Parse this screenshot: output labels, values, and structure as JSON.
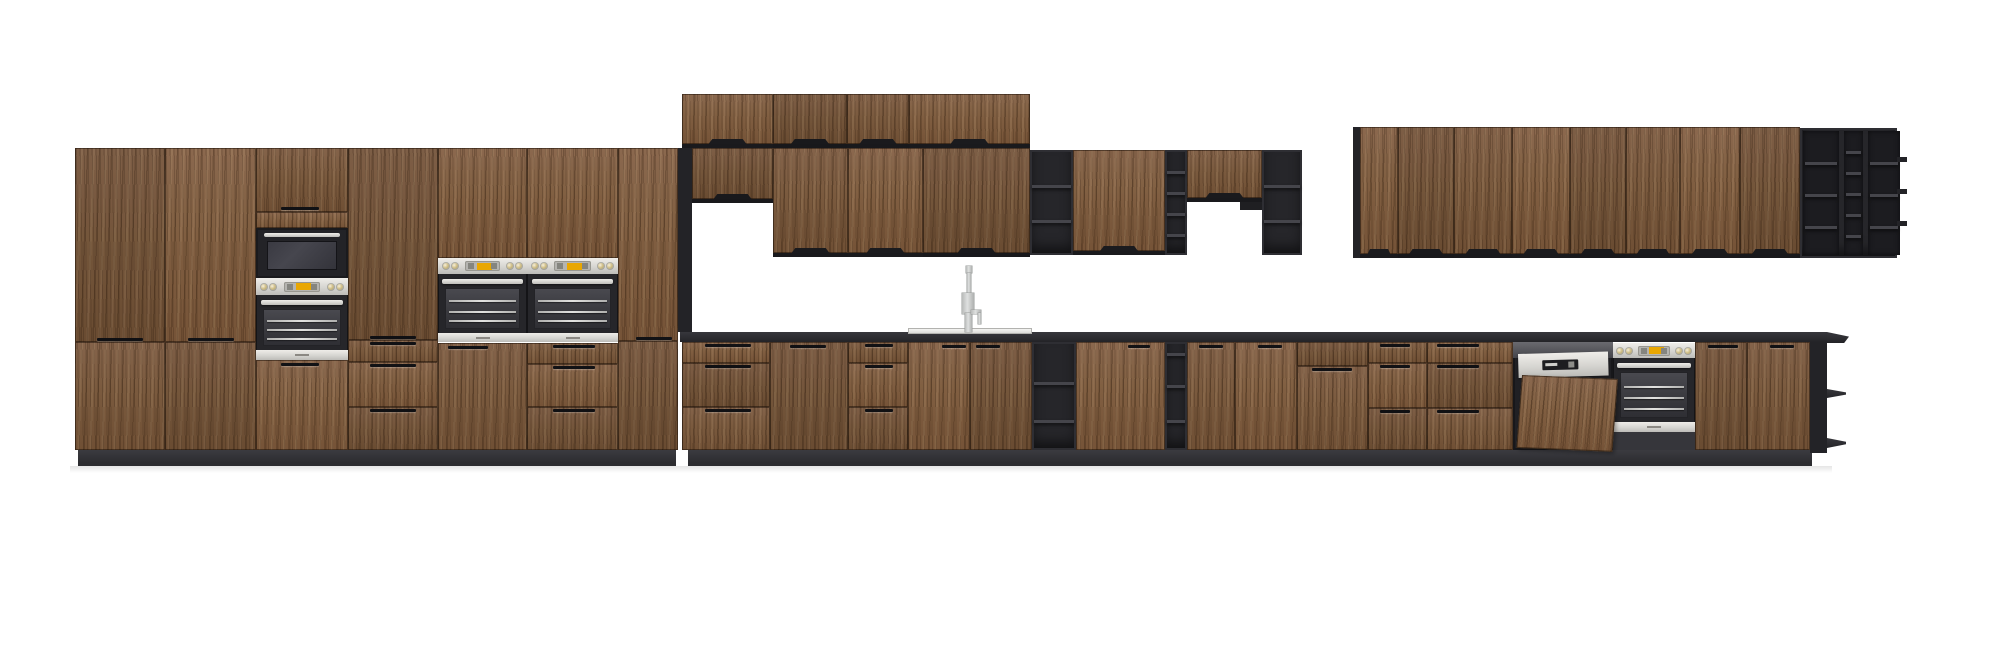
{
  "app": {
    "view_label": "kitchen-elevation-render"
  },
  "palette": {
    "wood": "#7a593c",
    "unit_black": "#232327",
    "counter": "#2b2b2f",
    "plinth": "#323236",
    "steel": "#d8d7d3",
    "display_amber": "#e9a702",
    "cavity": "#3c3c40",
    "sink": "#e9e9e7",
    "faucet": "#c5c7c7",
    "background": "#ffffff"
  },
  "scene": {
    "w": 2000,
    "h": 662,
    "items": [
      {
        "n": "countertop",
        "t": "rect",
        "b": [
          680,
          332,
          1147,
          10
        ],
        "cls": "ct"
      },
      {
        "n": "countertop-end",
        "t": "rect",
        "b": [
          1827,
          332,
          22,
          11
        ],
        "cls": "ct",
        "clip": "polygon(0 0,100% 42%,78% 100%,0 100%)"
      },
      {
        "n": "plinth",
        "t": "rect",
        "b": [
          78,
          450,
          598,
          16
        ],
        "cls": "pl",
        "i": false
      },
      {
        "n": "plinth",
        "t": "rect",
        "b": [
          688,
          450,
          1124,
          16
        ],
        "cls": "pl",
        "i": false
      },
      {
        "n": "floor-shadow",
        "t": "shadow",
        "b": [
          70,
          466,
          1762,
          7
        ],
        "i": false
      },
      {
        "n": "tall-cabinet-door",
        "t": "wood",
        "b": [
          75,
          148,
          90,
          194
        ],
        "h1": [
          22,
          190,
          46
        ]
      },
      {
        "n": "tall-cabinet-lower-door",
        "t": "wood",
        "b": [
          75,
          342,
          90,
          108
        ]
      },
      {
        "n": "tall-cabinet-door",
        "t": "wood",
        "b": [
          165,
          148,
          91,
          194
        ],
        "h1": [
          23,
          190,
          46
        ]
      },
      {
        "n": "tall-cabinet-lower-door",
        "t": "wood",
        "b": [
          165,
          342,
          91,
          108
        ]
      },
      {
        "n": "appliance-tower-top-door",
        "t": "wood",
        "b": [
          256,
          148,
          92,
          64
        ],
        "h1": [
          25,
          59,
          38
        ]
      },
      {
        "n": "appliance-tower-filler",
        "t": "wood",
        "b": [
          256,
          212,
          92,
          16
        ],
        "i": false
      },
      {
        "n": "microwave",
        "t": "micro",
        "b": [
          256,
          228,
          92,
          50
        ]
      },
      {
        "n": "tower-wall-oven",
        "t": "oven",
        "b": [
          256,
          278,
          92,
          82
        ],
        "ctrl": 17,
        "bs": 10
      },
      {
        "n": "appliance-tower-lower-door",
        "t": "wood",
        "b": [
          256,
          360,
          92,
          90
        ],
        "h1": [
          25,
          3,
          38
        ]
      },
      {
        "n": "tall-cabinet-door",
        "t": "wood",
        "b": [
          348,
          148,
          90,
          192
        ],
        "h1": [
          22,
          188,
          46
        ]
      },
      {
        "n": "tall-drawer-stack",
        "t": "drawers",
        "b": [
          348,
          340,
          90,
          110
        ],
        "rows": [
          22,
          45,
          43
        ],
        "hx": [
          22,
          46
        ]
      },
      {
        "n": "oven-upper-door",
        "t": "wood",
        "b": [
          438,
          148,
          89,
          110
        ]
      },
      {
        "n": "wall-oven",
        "t": "oven",
        "b": [
          438,
          258,
          89,
          84
        ],
        "ctrl": 16,
        "bs": 9
      },
      {
        "n": "oven-lower-door",
        "t": "wood",
        "b": [
          438,
          343,
          89,
          107
        ],
        "h1": [
          10,
          3,
          40
        ]
      },
      {
        "n": "oven-upper-door",
        "t": "wood",
        "b": [
          527,
          148,
          91,
          110
        ]
      },
      {
        "n": "wall-oven",
        "t": "oven",
        "b": [
          527,
          258,
          91,
          84
        ],
        "ctrl": 16,
        "bs": 9
      },
      {
        "n": "tall-drawer-stack",
        "t": "drawers",
        "b": [
          527,
          343,
          91,
          107
        ],
        "rows": [
          21,
          43,
          43
        ],
        "hx": [
          26,
          42
        ]
      },
      {
        "n": "tall-cabinet-door",
        "t": "wood",
        "b": [
          618,
          148,
          60,
          193
        ],
        "h1": [
          18,
          189,
          36
        ]
      },
      {
        "n": "tall-cabinet-lower-door",
        "t": "wood",
        "b": [
          618,
          341,
          60,
          109
        ]
      },
      {
        "n": "open-column-unit",
        "t": "rect",
        "b": [
          678,
          148,
          14,
          184
        ],
        "c": "unit_black"
      },
      {
        "n": "upper-cabinet-door",
        "t": "udoor",
        "b": [
          682,
          94,
          91,
          54
        ]
      },
      {
        "n": "upper-cabinet-door",
        "t": "udoor",
        "b": [
          773,
          94,
          74,
          54
        ]
      },
      {
        "n": "upper-cabinet-door",
        "t": "udoor",
        "b": [
          847,
          94,
          62,
          54
        ]
      },
      {
        "n": "upper-cabinet-door",
        "t": "udoor",
        "b": [
          909,
          94,
          121,
          54
        ]
      },
      {
        "n": "upper-short-door",
        "t": "udoor",
        "b": [
          692,
          148,
          81,
          55
        ]
      },
      {
        "n": "upper-cabinet-door",
        "t": "udoor",
        "b": [
          773,
          148,
          75,
          109
        ]
      },
      {
        "n": "upper-cabinet-door",
        "t": "udoor",
        "b": [
          848,
          148,
          75,
          109
        ]
      },
      {
        "n": "upper-cabinet-door",
        "t": "udoor",
        "b": [
          923,
          148,
          107,
          109
        ]
      },
      {
        "n": "open-shelf-unit",
        "t": "open",
        "b": [
          1030,
          150,
          43,
          105
        ],
        "sh": [
          35,
          70
        ]
      },
      {
        "n": "upper-cabinet-door",
        "t": "udoor",
        "b": [
          1073,
          150,
          92,
          105
        ]
      },
      {
        "n": "open-shelf-narrow",
        "t": "open",
        "b": [
          1165,
          150,
          22,
          105
        ],
        "sh": [
          21,
          42,
          63,
          84
        ]
      },
      {
        "n": "upper-short-door",
        "t": "udoor",
        "b": [
          1187,
          150,
          75,
          52
        ]
      },
      {
        "n": "mount-bracket",
        "t": "rect",
        "b": [
          1240,
          202,
          22,
          8
        ],
        "c": "#1f1f22",
        "i": false
      },
      {
        "n": "open-shelf-unit",
        "t": "open",
        "b": [
          1262,
          150,
          40,
          105
        ],
        "sh": [
          35,
          70
        ]
      },
      {
        "n": "side-panel",
        "t": "rect",
        "b": [
          1353,
          127,
          7,
          131
        ],
        "c": "unit_black",
        "i": false
      },
      {
        "n": "upper-cabinet-door",
        "t": "udoor",
        "b": [
          1360,
          127,
          38,
          131
        ]
      },
      {
        "n": "upper-cabinet-door",
        "t": "udoor",
        "b": [
          1398,
          127,
          56,
          131
        ]
      },
      {
        "n": "upper-cabinet-door",
        "t": "udoor",
        "b": [
          1454,
          127,
          58,
          131
        ]
      },
      {
        "n": "upper-cabinet-door",
        "t": "udoor",
        "b": [
          1512,
          127,
          58,
          131
        ]
      },
      {
        "n": "upper-cabinet-door",
        "t": "udoor",
        "b": [
          1570,
          127,
          56,
          131
        ]
      },
      {
        "n": "upper-cabinet-door",
        "t": "udoor",
        "b": [
          1626,
          127,
          54,
          131
        ]
      },
      {
        "n": "upper-cabinet-door",
        "t": "udoor",
        "b": [
          1680,
          127,
          60,
          131
        ]
      },
      {
        "n": "upper-cabinet-door",
        "t": "udoor",
        "b": [
          1740,
          127,
          60,
          131
        ]
      },
      {
        "n": "open-shelf-grid",
        "t": "grid",
        "b": [
          1800,
          128,
          97,
          130
        ],
        "cols": [
          {
            "w": 36,
            "sh": [
              31,
              63,
              95
            ]
          },
          {
            "w": 19,
            "sh": [
              20,
              41,
              62,
              83,
              104
            ]
          },
          {
            "w": 32,
            "sh": [
              31,
              63,
              95
            ]
          }
        ]
      },
      {
        "n": "shelf-edge",
        "t": "rect",
        "b": [
          1897,
          157,
          10,
          5
        ],
        "c": "unit_black",
        "i": false
      },
      {
        "n": "shelf-edge",
        "t": "rect",
        "b": [
          1897,
          189,
          10,
          5
        ],
        "c": "unit_black",
        "i": false
      },
      {
        "n": "shelf-edge",
        "t": "rect",
        "b": [
          1897,
          221,
          10,
          5
        ],
        "c": "unit_black",
        "i": false
      },
      {
        "n": "base-drawer-stack",
        "t": "drawers",
        "b": [
          682,
          342,
          88,
          108
        ],
        "rows": [
          21,
          44,
          43
        ],
        "hx": [
          23,
          46
        ]
      },
      {
        "n": "base-door",
        "t": "wood",
        "b": [
          770,
          342,
          78,
          108
        ],
        "h1": [
          20,
          3,
          36
        ]
      },
      {
        "n": "base-drawer-stack",
        "t": "drawers",
        "b": [
          848,
          342,
          60,
          108
        ],
        "rows": [
          21,
          44,
          43
        ],
        "hx": [
          17,
          28
        ]
      },
      {
        "n": "sink-base-door",
        "t": "wood",
        "b": [
          908,
          342,
          62,
          108
        ],
        "h1": [
          34,
          3,
          24
        ]
      },
      {
        "n": "sink-base-door",
        "t": "wood",
        "b": [
          970,
          342,
          62,
          108
        ],
        "h1": [
          6,
          3,
          24
        ]
      },
      {
        "n": "open-base-unit",
        "t": "open",
        "b": [
          1032,
          342,
          44,
          108
        ],
        "sh": [
          40,
          78
        ]
      },
      {
        "n": "base-door",
        "t": "wood",
        "b": [
          1076,
          342,
          89,
          108
        ],
        "h1": [
          52,
          3,
          22
        ]
      },
      {
        "n": "open-shelf-narrow",
        "t": "open",
        "b": [
          1165,
          342,
          22,
          108
        ],
        "sh": [
          11,
          43,
          78
        ]
      },
      {
        "n": "base-door",
        "t": "wood",
        "b": [
          1187,
          342,
          48,
          108
        ],
        "h1": [
          12,
          3,
          24
        ]
      },
      {
        "n": "base-door",
        "t": "wood",
        "b": [
          1235,
          342,
          62,
          108
        ],
        "h1": [
          23,
          3,
          24
        ]
      },
      {
        "n": "drawer-door-unit",
        "t": "drawers",
        "b": [
          1297,
          342,
          71,
          108
        ],
        "rows": [
          24,
          84
        ],
        "hx": [
          15,
          40
        ],
        "skip0": true
      },
      {
        "n": "base-drawer-stack",
        "t": "drawers",
        "b": [
          1368,
          342,
          59,
          108
        ],
        "rows": [
          21,
          45,
          42
        ],
        "hx": [
          12,
          30
        ]
      },
      {
        "n": "base-drawer-stack",
        "t": "drawers",
        "b": [
          1427,
          342,
          86,
          108
        ],
        "rows": [
          21,
          45,
          42
        ],
        "hx": [
          10,
          42
        ]
      },
      {
        "n": "built-under-oven",
        "t": "oven",
        "b": [
          1613,
          343,
          82,
          89
        ],
        "ctrl": 15,
        "bs": 10
      },
      {
        "n": "oven-base-trim",
        "t": "rect",
        "b": [
          1613,
          432,
          82,
          18
        ],
        "c": "#36363b",
        "i": false
      },
      {
        "n": "dishwasher",
        "t": "dw",
        "b": [
          1513,
          342,
          100,
          108
        ]
      },
      {
        "n": "base-door",
        "t": "wood",
        "b": [
          1695,
          342,
          52,
          108
        ],
        "h1": [
          13,
          3,
          30
        ]
      },
      {
        "n": "base-door",
        "t": "wood",
        "b": [
          1747,
          342,
          63,
          108
        ],
        "h1": [
          23,
          3,
          24
        ]
      },
      {
        "n": "end-panel",
        "t": "rect",
        "b": [
          1810,
          342,
          17,
          111
        ],
        "c": "unit_black",
        "i": false
      },
      {
        "n": "end-open-shelf",
        "t": "rect",
        "b": [
          1827,
          389,
          19,
          9
        ],
        "cls": "ct",
        "clip": "polygon(0 0,100% 38%,100% 62%,0 100%)"
      },
      {
        "n": "end-open-shelf",
        "t": "rect",
        "b": [
          1827,
          438,
          19,
          10
        ],
        "cls": "ct",
        "clip": "polygon(0 0,100% 38%,100% 62%,0 100%)"
      },
      {
        "n": "sink-rim",
        "t": "rect",
        "b": [
          908,
          328,
          124,
          6
        ],
        "cls": "sinkrim"
      },
      {
        "n": "faucet-tip",
        "t": "rect",
        "b": [
          966,
          266,
          6,
          7
        ],
        "cls": "fc"
      },
      {
        "n": "faucet-neck",
        "t": "rect",
        "b": [
          967,
          273,
          4,
          22
        ],
        "cls": "fc"
      },
      {
        "n": "faucet-body",
        "t": "rect",
        "b": [
          962,
          293,
          12,
          21
        ],
        "cls": "fc"
      },
      {
        "n": "faucet-column",
        "t": "rect",
        "b": [
          965,
          313,
          7,
          19
        ],
        "cls": "fc"
      },
      {
        "n": "faucet-lever",
        "t": "rect",
        "b": [
          971,
          310,
          10,
          4
        ],
        "cls": "fc"
      },
      {
        "n": "faucet-lever-drop",
        "t": "rect",
        "b": [
          978,
          313,
          3,
          11
        ],
        "cls": "fc"
      }
    ]
  }
}
